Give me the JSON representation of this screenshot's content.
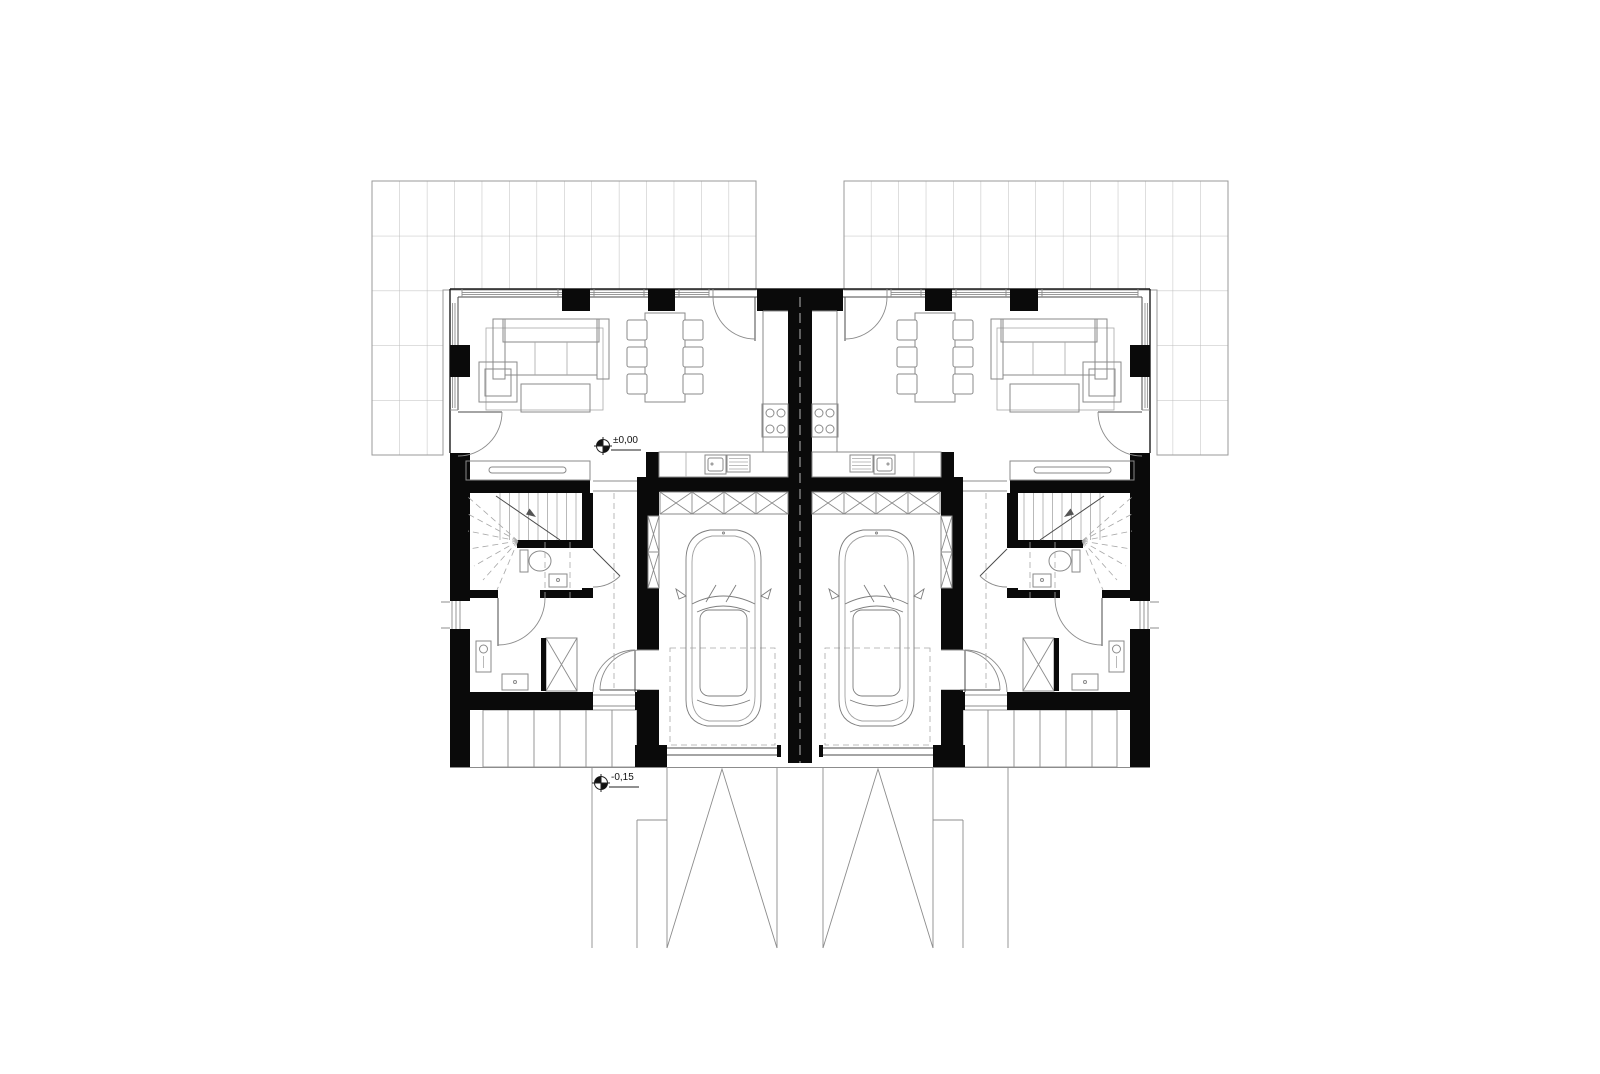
{
  "colors": {
    "wall": "#0a0a0a",
    "line": "#4a4a4a",
    "light_line": "#8c8c8c",
    "background": "#ffffff"
  },
  "markers": {
    "ground_floor_level": {
      "label": "±0,00"
    },
    "exterior_level": {
      "label": "-0,15"
    }
  }
}
